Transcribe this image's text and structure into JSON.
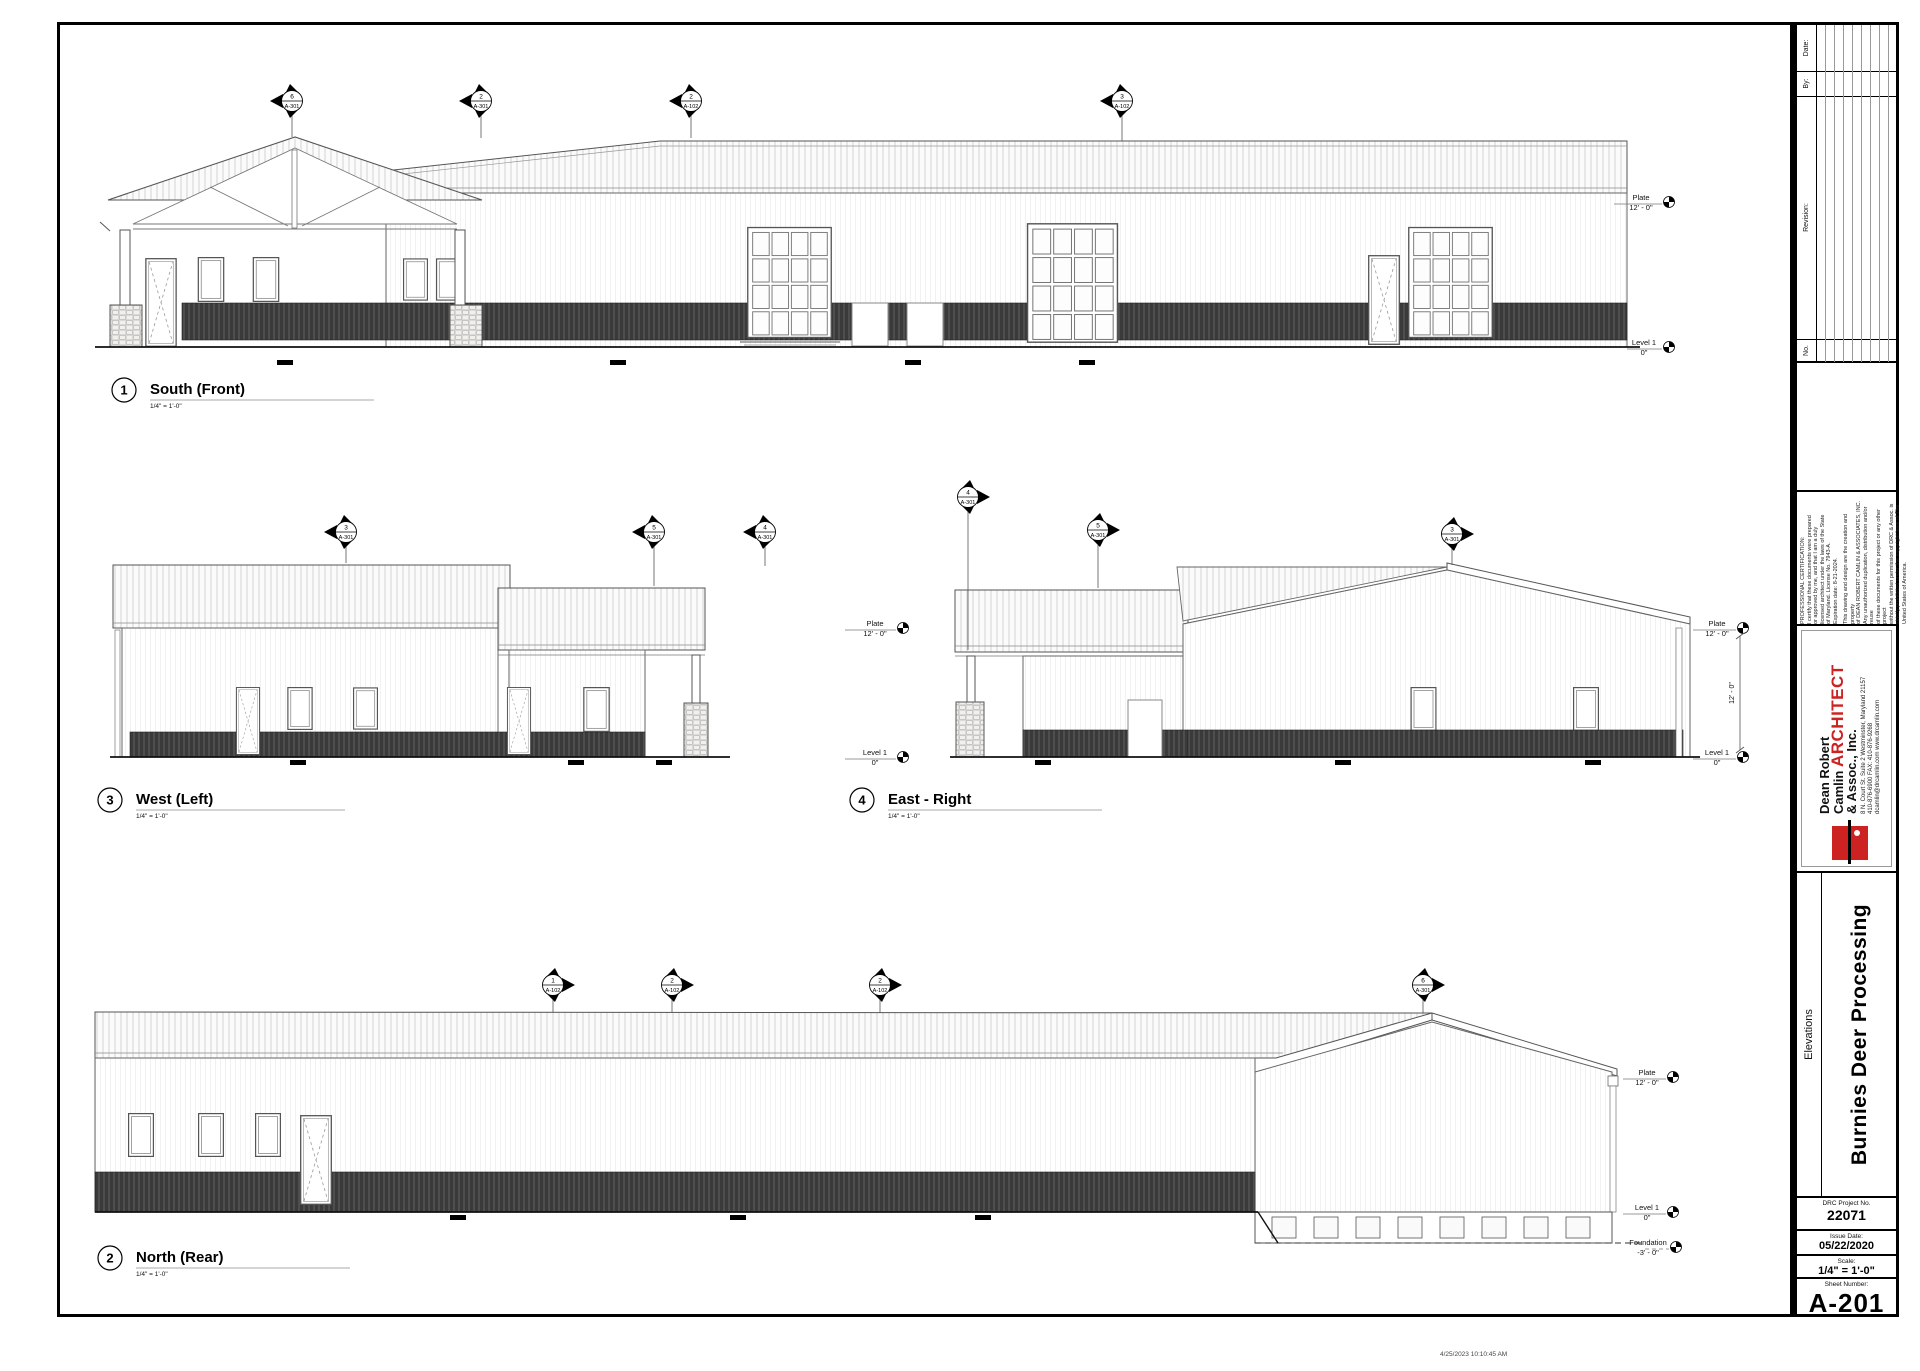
{
  "sheet": {
    "timestamp": "4/25/2023 10:10:45 AM",
    "titleblock": {
      "revision": {
        "date_label": "Date:",
        "by_label": "By:",
        "revision_label": "Revision:",
        "no_label": "No."
      },
      "certification": {
        "p1": "PROFESSIONAL CERTIFICATION:\nI certify that these documents were prepared\nor approved by me, and that I am a duly\nlicensed architect under the laws of the State\nof Maryland. License No. 7943-A.\nExpiration date: 8-21-2024.",
        "p2": "This drawing and design are the creation and property\nof DEAN ROBERT CAMLIN & ASSOCIATES, INC.\nAny unauthorized duplication, distribution and/or reuse\nof these documents for this project or any other project\nwithout the written permission of DRC & Assoc. is\nstrictly prohibited under the copyright laws of The\nUnited States of America."
      },
      "firm": {
        "name_line1": "Dean Robert",
        "name_line2_black": "Camlin ",
        "name_line2_red": "ARCHITECT",
        "name_line3": "& Assoc., Inc.",
        "address": "8 N. Court St. Suite 2  Westminster, Maryland 21157",
        "phone": "410-876-6900   FAX: 410-876-9268",
        "web": "dcamlin@drcamlin.com   www.drcamlin.com",
        "logo_color": "#cc2222"
      },
      "sheet_title": "Elevations",
      "project_name": "Burnies Deer Processing",
      "project_no_label": "DRC Project No.",
      "project_no": "22071",
      "issue_date_label": "Issue Date:",
      "issue_date": "05/22/2020",
      "scale_label": "Scale:",
      "scale": "1/4\" = 1'-0\"",
      "sheet_number_label": "Sheet Number:",
      "sheet_number": "A-201"
    },
    "views": {
      "south": {
        "num": "1",
        "name": "South (Front)",
        "scale": "1/4\" = 1'-0\""
      },
      "west": {
        "num": "3",
        "name": "West (Left)",
        "scale": "1/4\" = 1'-0\""
      },
      "east": {
        "num": "4",
        "name": "East - Right",
        "scale": "1/4\" = 1'-0\""
      },
      "north": {
        "num": "2",
        "name": "North (Rear)",
        "scale": "1/4\" = 1'-0\""
      }
    },
    "ann": {
      "plate": "Plate",
      "plate_v": "12' - 0\"",
      "level": "Level 1",
      "level_v": "0\"",
      "found": "Foundation",
      "found_v": "-3' - 0\"",
      "dim12": "12' - 0\""
    },
    "markers": {
      "south": [
        {
          "num": "6",
          "sheet": "A-301"
        },
        {
          "num": "2",
          "sheet": "A-301"
        },
        {
          "num": "2",
          "sheet": "A-102"
        },
        {
          "num": "3",
          "sheet": "A-102"
        }
      ],
      "west": [
        {
          "num": "3",
          "sheet": "A-301"
        },
        {
          "num": "5",
          "sheet": "A-301"
        },
        {
          "num": "4",
          "sheet": "A-301"
        }
      ],
      "east": [
        {
          "num": "4",
          "sheet": "A-301"
        },
        {
          "num": "5",
          "sheet": "A-301"
        },
        {
          "num": "3",
          "sheet": "A-301"
        }
      ],
      "north": [
        {
          "num": "1",
          "sheet": "A-102"
        },
        {
          "num": "2",
          "sheet": "A-102"
        },
        {
          "num": "2",
          "sheet": "A-102"
        },
        {
          "num": "6",
          "sheet": "A-301"
        }
      ]
    }
  }
}
